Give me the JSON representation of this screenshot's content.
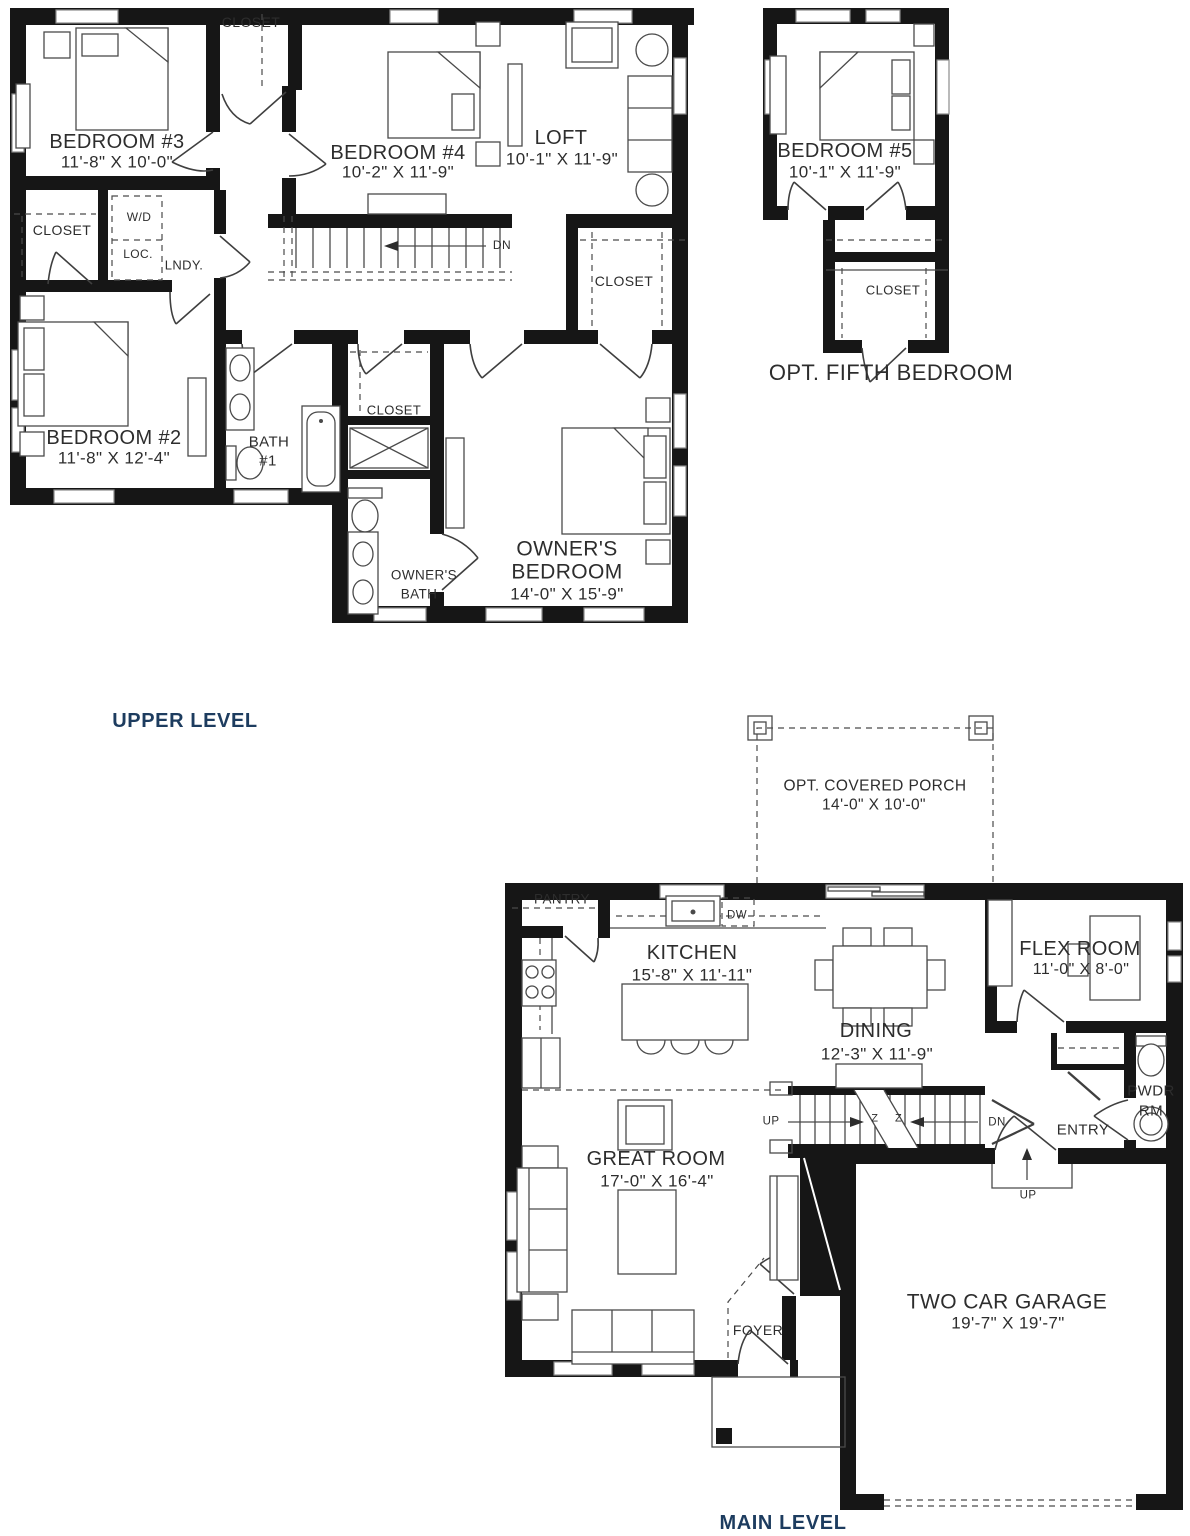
{
  "colors": {
    "walls": "#161616",
    "plan_text": "#2d2d2d",
    "caption_text": "#1d3c5f"
  },
  "upper": {
    "caption": "UPPER LEVEL",
    "bedroom3_name": "BEDROOM #3",
    "bedroom3_dims": "11'-8\" X 10'-0\"",
    "bedroom4_name": "BEDROOM #4",
    "bedroom4_dims": "10'-2\" X 11'-9\"",
    "loft_name": "LOFT",
    "loft_dims": "10'-1\" X 11'-9\"",
    "bedroom2_name": "BEDROOM #2",
    "bedroom2_dims": "11'-8\" X 12'-4\"",
    "owners_bedroom_name1": "OWNER'S",
    "owners_bedroom_name2": "BEDROOM",
    "owners_bedroom_dims": "14'-0\" X 15'-9\"",
    "bath1_line1": "BATH",
    "bath1_line2": "#1",
    "owners_bath_line1": "OWNER'S",
    "owners_bath_line2": "BATH",
    "closet_top": "CLOSET",
    "closet_left": "CLOSET",
    "closet_mid": "CLOSET",
    "closet_walkin": "CLOSET",
    "wd_line1": "W/D",
    "wd_line2": "LOC.",
    "lndy": "LNDY.",
    "stairs_dn": "DN"
  },
  "fifth": {
    "caption": "OPT. FIFTH BEDROOM",
    "name": "BEDROOM #5",
    "dims": "10'-1\" X 11'-9\"",
    "closet": "CLOSET"
  },
  "main": {
    "caption": "MAIN LEVEL",
    "porch_name": "OPT. COVERED PORCH",
    "porch_dims": "14'-0\" X 10'-0\"",
    "pantry": "PANTRY",
    "kitchen_name": "KITCHEN",
    "kitchen_dims": "15'-8\" X 11'-11\"",
    "dw": "DW",
    "dining_name": "DINING",
    "dining_dims": "12'-3\" X 11'-9\"",
    "flex_name": "FLEX ROOM",
    "flex_dims": "11'-0\" X 8'-0\"",
    "pwdr_line1": "PWDR",
    "pwdr_line2": "RM",
    "entry": "ENTRY",
    "great_name": "GREAT ROOM",
    "great_dims": "17'-0\" X 16'-4\"",
    "foyer": "FOYER",
    "garage_name": "TWO CAR GARAGE",
    "garage_dims": "19'-7\" X 19'-7\"",
    "stairs_up": "UP",
    "stairs_dn": "DN",
    "stairs_up2": "UP",
    "break_symbol": "Z Z"
  }
}
